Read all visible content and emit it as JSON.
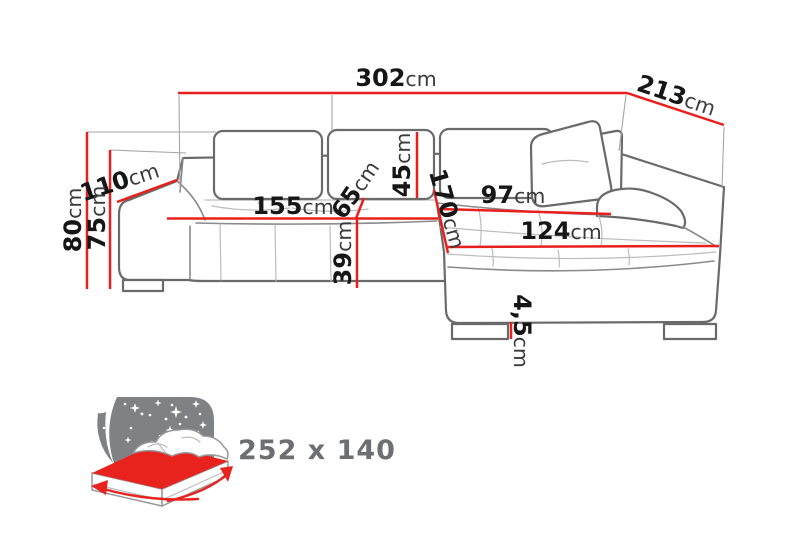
{
  "colors": {
    "dimension_line": "#e8201d",
    "number_text": "#161616",
    "unit_text": "#3b3b3b",
    "sofa_outline": "#6a6a6a",
    "icon_gray": "#808184",
    "icon_red": "#e8231e",
    "size_text": "#6d6e71"
  },
  "dimensions": {
    "total_width": {
      "value": "302",
      "unit": "cm"
    },
    "total_depth": {
      "value": "213",
      "unit": "cm"
    },
    "armrest_width": {
      "value": "110",
      "unit": "cm"
    },
    "total_height": {
      "value": "80",
      "unit": "cm"
    },
    "armrest_height": {
      "value": "75",
      "unit": "cm"
    },
    "seat_width": {
      "value": "155",
      "unit": "cm"
    },
    "seat_depth": {
      "value": "65",
      "unit": "cm"
    },
    "backrest_height": {
      "value": "45",
      "unit": "cm"
    },
    "seat_height": {
      "value": "39",
      "unit": "cm"
    },
    "chaise_length": {
      "value": "170",
      "unit": "cm"
    },
    "chaise_seat_width": {
      "value": "97",
      "unit": "cm"
    },
    "chaise_width": {
      "value": "124",
      "unit": "cm"
    },
    "leg_height": {
      "value": "4,5",
      "unit": "cm"
    }
  },
  "sleeping_area": {
    "size": "252 x 140",
    "icon": "sofa-bed-sleeping-function-icon"
  }
}
